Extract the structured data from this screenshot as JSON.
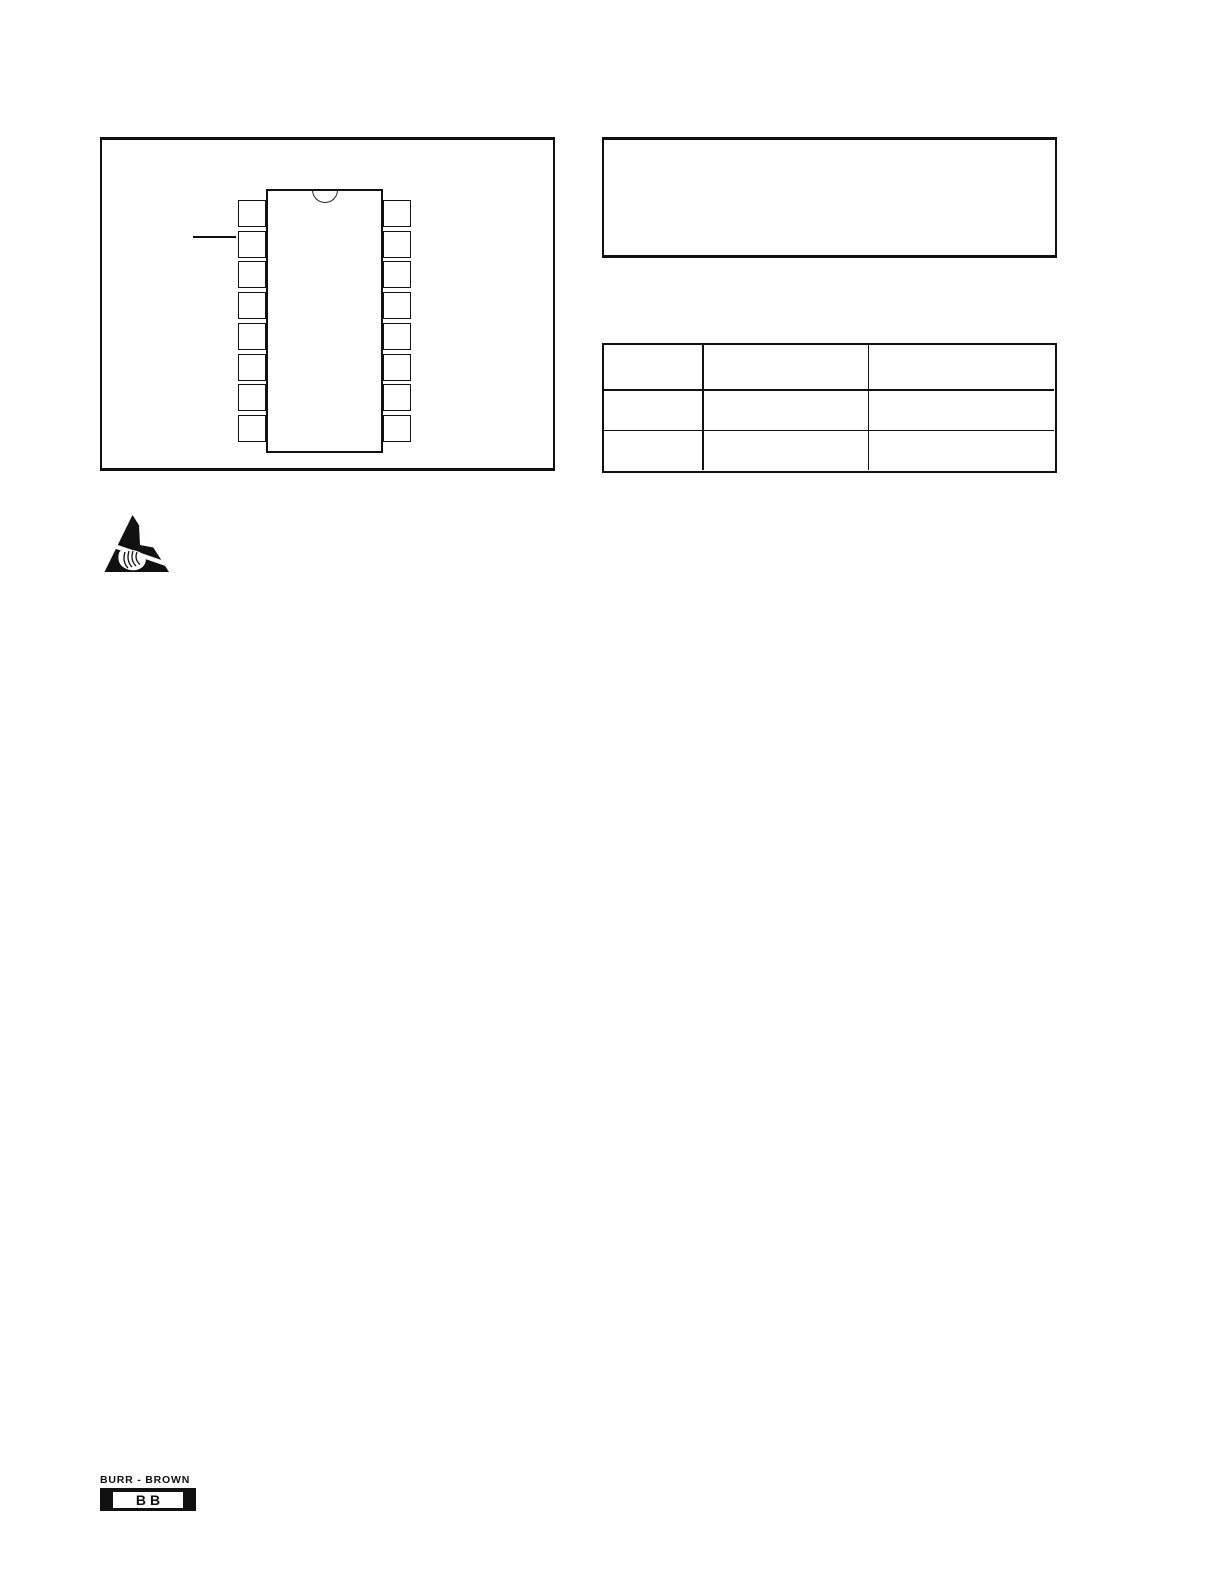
{
  "page": {
    "background": "#ffffff",
    "ink_color": "#111111"
  },
  "figure_panel": {
    "package_diagram": {
      "package_style": "dual-in-line",
      "pins_per_side": 8,
      "total_pins": 16,
      "notch_position": "top-center",
      "pin_pointer": {
        "side": "left",
        "pin_index": 2
      }
    }
  },
  "info_panel": {
    "content": ""
  },
  "data_table": {
    "rows": [
      [
        "",
        "",
        ""
      ],
      [
        "",
        "",
        ""
      ],
      [
        "",
        "",
        ""
      ]
    ]
  },
  "esd_symbol": {
    "icon": "esd-warning-triangle"
  },
  "footer_logo": {
    "brand": "BURR - BROWN",
    "monogram": "BB"
  }
}
